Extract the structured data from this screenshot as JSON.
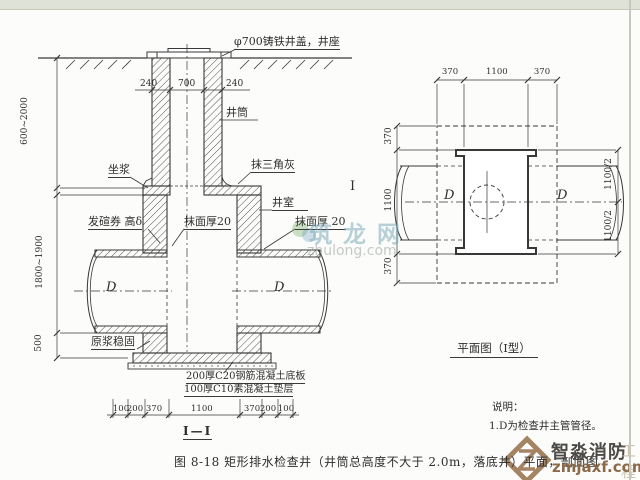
{
  "caption": "图 8-18  矩形排水检查井（井筒总高度不大于 2.0m，落底井）平面，剖面图",
  "section": {
    "title": "I—I",
    "marker": "I",
    "labels": {
      "cover": "φ700铸铁井盖，井座",
      "shaft": "井筒",
      "mortar": "坐浆",
      "fillet": "抹三角灰",
      "chamber": "井室",
      "arch": "发碹券 高δ",
      "plaster_mid": "抹面厚20",
      "plaster_right": "抹面厚 20",
      "grout": "原浆稳固",
      "slab": "200厚C20钢筋混凝土底板",
      "cushion": "100厚C10素混凝土垫层"
    },
    "dims": {
      "shaft_top": [
        "240",
        "700",
        "240"
      ],
      "left": [
        "600~2000",
        "1800~1900",
        "500"
      ],
      "bottom": [
        "100",
        "200",
        "370",
        "1100",
        "370",
        "200",
        "100"
      ],
      "pipe_left": "D",
      "pipe_right": "D"
    }
  },
  "plan": {
    "title": "平面图（I型）",
    "dims": {
      "top": [
        "370",
        "1100",
        "370"
      ],
      "left": [
        "370",
        "1100",
        "370"
      ],
      "right": [
        "1100/2",
        "1100/2"
      ]
    },
    "pipe_left": "D",
    "pipe_right": "D",
    "notes": {
      "heading": "说明：",
      "line1": "1.D为检查井主管管径。"
    }
  },
  "watermarks": {
    "zhulong": {
      "name": "筑龙网",
      "domain": "zhulong.com"
    },
    "zmjaxf": {
      "name": "智淼消防",
      "extra": "工程",
      "domain": "zmjaxf.com"
    }
  },
  "colors": {
    "line": "#383838",
    "topbar": "#dfe2d6"
  }
}
